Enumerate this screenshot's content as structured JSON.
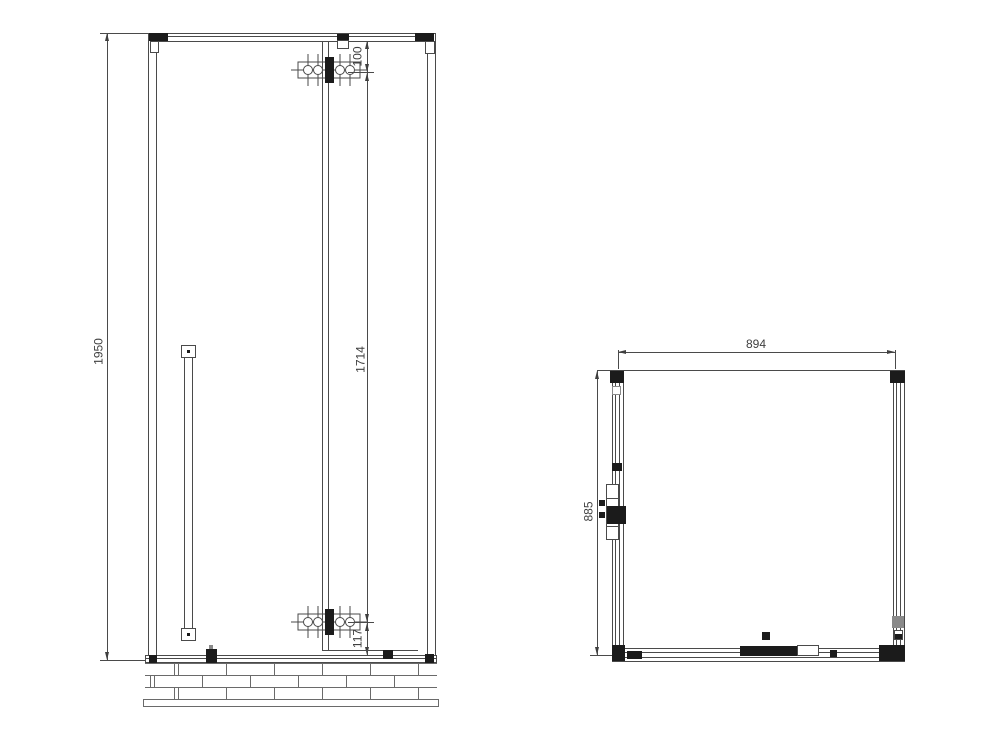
{
  "drawing": {
    "line_color": "#4a4a4a",
    "background": "#ffffff",
    "front_view": {
      "dim_overall_height": "1950",
      "dim_top_hinge_offset": "100",
      "dim_hinge_span": "1714",
      "dim_bottom_hinge_offset": "117"
    },
    "plan_view": {
      "dim_width": "894",
      "dim_depth": "885"
    }
  }
}
